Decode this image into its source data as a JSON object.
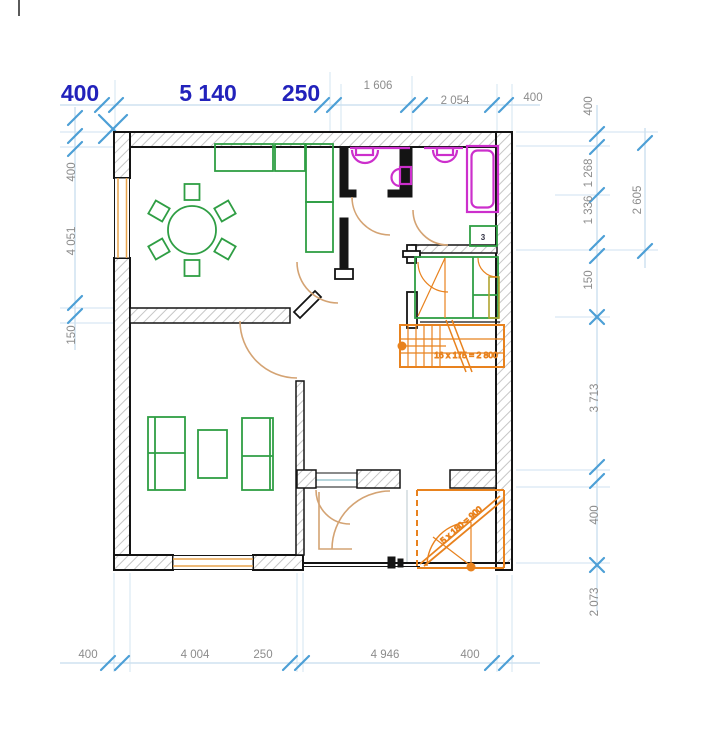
{
  "drawing": {
    "type": "architectural floor plan",
    "units": "mm"
  },
  "colors": {
    "dim_primary_blue": "#2222bb",
    "dim_secondary_gray": "#8c8c8c",
    "tick_blue": "#4d9fd6",
    "dim_line_blue": "#b7d3e8",
    "wall_black": "#141414",
    "hatch_gray": "#c6c6c6",
    "furniture_green": "#2f9e44",
    "fixture_magenta": "#cc2fcc",
    "stair_orange": "#e8821e",
    "door_tan": "#d4a373",
    "window_orange": "#e8a44d"
  },
  "dimensions": {
    "top_primary": [
      "400",
      "5 140",
      "250"
    ],
    "top_secondary": [
      "1 606",
      "2 054",
      "400"
    ],
    "left": [
      "400",
      "4 051",
      "150"
    ],
    "right_inner": [
      "400",
      "1 268",
      "1 336",
      "150",
      "3 713",
      "400",
      "2 073"
    ],
    "right_outer": [
      "2 605"
    ],
    "bottom": [
      "400",
      "4 004",
      "250",
      "4 946",
      "400"
    ]
  },
  "annotations": {
    "stair_main": "16 x 175 = 2 800",
    "stair_entry": "5 x 180 = 900",
    "room_marker": "3"
  }
}
